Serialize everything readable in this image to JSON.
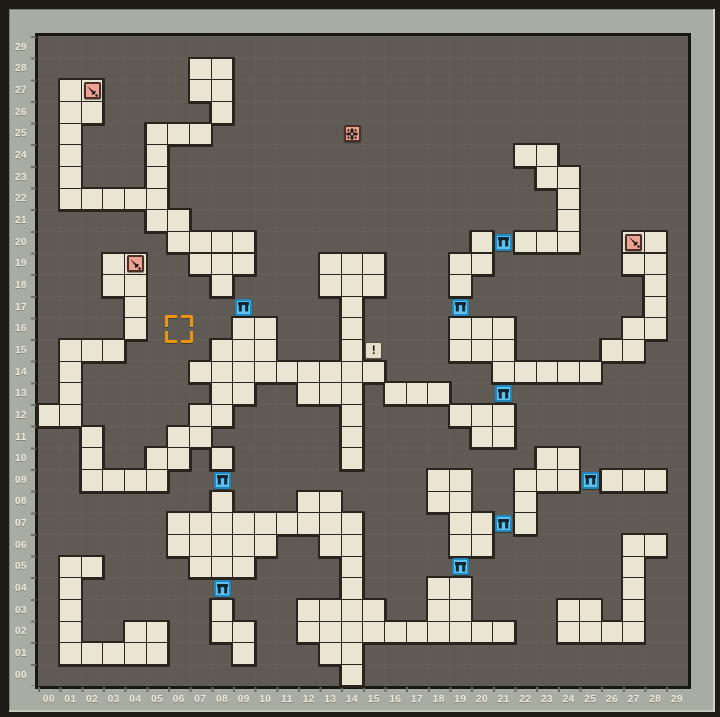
{
  "map": {
    "cols": 30,
    "rows": 30,
    "cell_w": 21.66,
    "cell_h": 21.65,
    "origin_x": 38,
    "origin_y": 36.5,
    "col_labels": [
      "00",
      "01",
      "02",
      "03",
      "04",
      "05",
      "06",
      "07",
      "08",
      "09",
      "10",
      "11",
      "12",
      "13",
      "14",
      "15",
      "16",
      "17",
      "18",
      "19",
      "20",
      "21",
      "22",
      "23",
      "24",
      "25",
      "26",
      "27",
      "28",
      "29"
    ],
    "row_labels_top_to_bottom": [
      "29",
      "28",
      "27",
      "26",
      "25",
      "24",
      "23",
      "22",
      "21",
      "20",
      "19",
      "18",
      "17",
      "16",
      "15",
      "14",
      "13",
      "12",
      "11",
      "10",
      "09",
      "08",
      "07",
      "06",
      "05",
      "04",
      "03",
      "02",
      "01",
      "00"
    ],
    "floor_cells": [
      [
        7,
        28
      ],
      [
        8,
        28
      ],
      [
        1,
        27
      ],
      [
        2,
        27
      ],
      [
        7,
        27
      ],
      [
        8,
        27
      ],
      [
        1,
        26
      ],
      [
        2,
        26
      ],
      [
        8,
        26
      ],
      [
        1,
        25
      ],
      [
        5,
        25
      ],
      [
        6,
        25
      ],
      [
        7,
        25
      ],
      [
        1,
        24
      ],
      [
        5,
        24
      ],
      [
        22,
        24
      ],
      [
        23,
        24
      ],
      [
        1,
        23
      ],
      [
        5,
        23
      ],
      [
        23,
        23
      ],
      [
        24,
        23
      ],
      [
        1,
        22
      ],
      [
        2,
        22
      ],
      [
        3,
        22
      ],
      [
        4,
        22
      ],
      [
        5,
        22
      ],
      [
        24,
        22
      ],
      [
        5,
        21
      ],
      [
        6,
        21
      ],
      [
        24,
        21
      ],
      [
        6,
        20
      ],
      [
        7,
        20
      ],
      [
        8,
        20
      ],
      [
        9,
        20
      ],
      [
        20,
        20
      ],
      [
        22,
        20
      ],
      [
        23,
        20
      ],
      [
        24,
        20
      ],
      [
        27,
        20
      ],
      [
        28,
        20
      ],
      [
        3,
        19
      ],
      [
        4,
        19
      ],
      [
        7,
        19
      ],
      [
        8,
        19
      ],
      [
        9,
        19
      ],
      [
        13,
        19
      ],
      [
        14,
        19
      ],
      [
        15,
        19
      ],
      [
        19,
        19
      ],
      [
        20,
        19
      ],
      [
        27,
        19
      ],
      [
        28,
        19
      ],
      [
        3,
        18
      ],
      [
        4,
        18
      ],
      [
        8,
        18
      ],
      [
        13,
        18
      ],
      [
        14,
        18
      ],
      [
        15,
        18
      ],
      [
        19,
        18
      ],
      [
        28,
        18
      ],
      [
        4,
        17
      ],
      [
        14,
        17
      ],
      [
        28,
        17
      ],
      [
        4,
        16
      ],
      [
        9,
        16
      ],
      [
        10,
        16
      ],
      [
        14,
        16
      ],
      [
        19,
        16
      ],
      [
        20,
        16
      ],
      [
        21,
        16
      ],
      [
        27,
        16
      ],
      [
        28,
        16
      ],
      [
        1,
        15
      ],
      [
        2,
        15
      ],
      [
        3,
        15
      ],
      [
        8,
        15
      ],
      [
        9,
        15
      ],
      [
        10,
        15
      ],
      [
        14,
        15
      ],
      [
        19,
        15
      ],
      [
        20,
        15
      ],
      [
        21,
        15
      ],
      [
        26,
        15
      ],
      [
        27,
        15
      ],
      [
        1,
        14
      ],
      [
        7,
        14
      ],
      [
        8,
        14
      ],
      [
        9,
        14
      ],
      [
        10,
        14
      ],
      [
        11,
        14
      ],
      [
        12,
        14
      ],
      [
        13,
        14
      ],
      [
        14,
        14
      ],
      [
        15,
        14
      ],
      [
        21,
        14
      ],
      [
        22,
        14
      ],
      [
        23,
        14
      ],
      [
        24,
        14
      ],
      [
        25,
        14
      ],
      [
        1,
        13
      ],
      [
        8,
        13
      ],
      [
        9,
        13
      ],
      [
        12,
        13
      ],
      [
        13,
        13
      ],
      [
        14,
        13
      ],
      [
        16,
        13
      ],
      [
        17,
        13
      ],
      [
        18,
        13
      ],
      [
        0,
        12
      ],
      [
        1,
        12
      ],
      [
        7,
        12
      ],
      [
        8,
        12
      ],
      [
        14,
        12
      ],
      [
        19,
        12
      ],
      [
        20,
        12
      ],
      [
        21,
        12
      ],
      [
        2,
        11
      ],
      [
        6,
        11
      ],
      [
        7,
        11
      ],
      [
        14,
        11
      ],
      [
        20,
        11
      ],
      [
        21,
        11
      ],
      [
        2,
        10
      ],
      [
        5,
        10
      ],
      [
        6,
        10
      ],
      [
        8,
        10
      ],
      [
        14,
        10
      ],
      [
        23,
        10
      ],
      [
        24,
        10
      ],
      [
        2,
        9
      ],
      [
        3,
        9
      ],
      [
        4,
        9
      ],
      [
        5,
        9
      ],
      [
        18,
        9
      ],
      [
        19,
        9
      ],
      [
        22,
        9
      ],
      [
        23,
        9
      ],
      [
        24,
        9
      ],
      [
        26,
        9
      ],
      [
        27,
        9
      ],
      [
        28,
        9
      ],
      [
        8,
        8
      ],
      [
        12,
        8
      ],
      [
        13,
        8
      ],
      [
        18,
        8
      ],
      [
        19,
        8
      ],
      [
        22,
        8
      ],
      [
        6,
        7
      ],
      [
        7,
        7
      ],
      [
        8,
        7
      ],
      [
        9,
        7
      ],
      [
        10,
        7
      ],
      [
        11,
        7
      ],
      [
        12,
        7
      ],
      [
        13,
        7
      ],
      [
        14,
        7
      ],
      [
        19,
        7
      ],
      [
        20,
        7
      ],
      [
        22,
        7
      ],
      [
        6,
        6
      ],
      [
        7,
        6
      ],
      [
        8,
        6
      ],
      [
        9,
        6
      ],
      [
        10,
        6
      ],
      [
        13,
        6
      ],
      [
        14,
        6
      ],
      [
        19,
        6
      ],
      [
        20,
        6
      ],
      [
        27,
        6
      ],
      [
        28,
        6
      ],
      [
        1,
        5
      ],
      [
        2,
        5
      ],
      [
        7,
        5
      ],
      [
        8,
        5
      ],
      [
        9,
        5
      ],
      [
        14,
        5
      ],
      [
        27,
        5
      ],
      [
        1,
        4
      ],
      [
        14,
        4
      ],
      [
        18,
        4
      ],
      [
        19,
        4
      ],
      [
        27,
        4
      ],
      [
        1,
        3
      ],
      [
        8,
        3
      ],
      [
        12,
        3
      ],
      [
        13,
        3
      ],
      [
        14,
        3
      ],
      [
        15,
        3
      ],
      [
        18,
        3
      ],
      [
        19,
        3
      ],
      [
        24,
        3
      ],
      [
        25,
        3
      ],
      [
        27,
        3
      ],
      [
        1,
        2
      ],
      [
        4,
        2
      ],
      [
        5,
        2
      ],
      [
        8,
        2
      ],
      [
        9,
        2
      ],
      [
        12,
        2
      ],
      [
        13,
        2
      ],
      [
        14,
        2
      ],
      [
        15,
        2
      ],
      [
        16,
        2
      ],
      [
        17,
        2
      ],
      [
        18,
        2
      ],
      [
        19,
        2
      ],
      [
        20,
        2
      ],
      [
        21,
        2
      ],
      [
        24,
        2
      ],
      [
        25,
        2
      ],
      [
        26,
        2
      ],
      [
        27,
        2
      ],
      [
        1,
        1
      ],
      [
        2,
        1
      ],
      [
        3,
        1
      ],
      [
        4,
        1
      ],
      [
        5,
        1
      ],
      [
        9,
        1
      ],
      [
        13,
        1
      ],
      [
        14,
        1
      ],
      [
        14,
        0
      ]
    ],
    "icons": [
      {
        "type": "sword",
        "col": 2,
        "row": 27
      },
      {
        "type": "sword",
        "col": 4,
        "row": 19
      },
      {
        "type": "sword",
        "col": 27,
        "row": 20
      },
      {
        "type": "trap",
        "col": 14,
        "row": 25
      },
      {
        "type": "note",
        "col": 15,
        "row": 15,
        "glyph": "!"
      },
      {
        "type": "door",
        "col": 21,
        "row": 20
      },
      {
        "type": "door",
        "col": 9,
        "row": 17
      },
      {
        "type": "door",
        "col": 19,
        "row": 17
      },
      {
        "type": "door",
        "col": 21,
        "row": 13
      },
      {
        "type": "door",
        "col": 8,
        "row": 9
      },
      {
        "type": "door",
        "col": 8,
        "row": 4
      },
      {
        "type": "door",
        "col": 19,
        "row": 5
      },
      {
        "type": "door",
        "col": 21,
        "row": 7
      },
      {
        "type": "door",
        "col": 25,
        "row": 9
      }
    ],
    "marker": {
      "col": 6,
      "row": 16,
      "color": "#ef920c"
    }
  },
  "colors": {
    "frame": "#a9aca2",
    "map_background": "#5f5b54",
    "floor": "#eae4d3",
    "floor_outline": "#29251e",
    "door_tile": "#5ec1f0",
    "sword_tile": "#eda294",
    "note_tile": "#e5dfca",
    "label_text": "#edeadb",
    "marker": "#ef920c"
  }
}
